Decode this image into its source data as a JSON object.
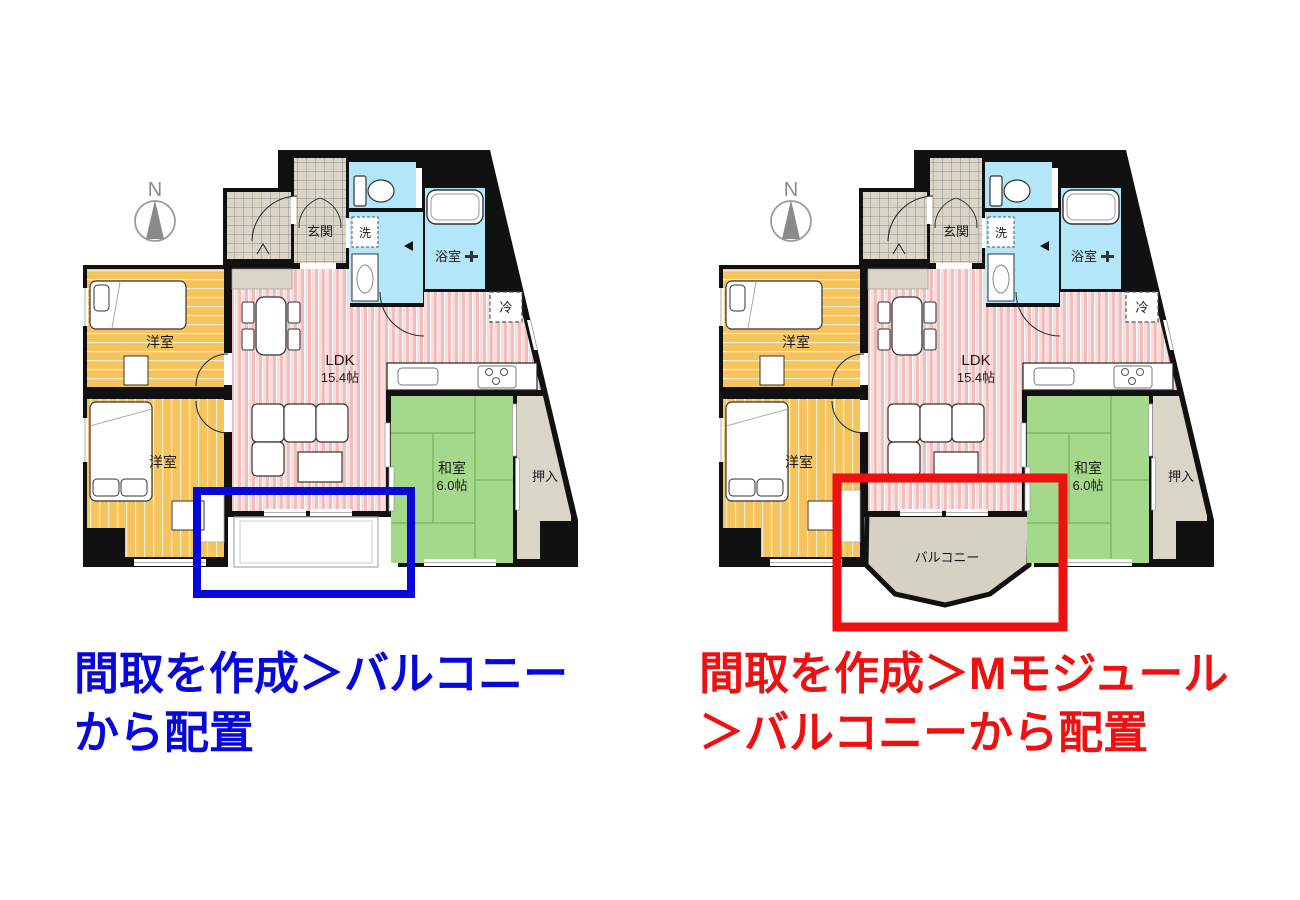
{
  "captions": {
    "left": {
      "line1": "間取を作成＞バルコニー",
      "line2": "から配置",
      "color": "#0808dd"
    },
    "right": {
      "line1": "間取を作成＞Mモジュール",
      "line2": "＞バルコニーから配置",
      "color": "#ee1111"
    }
  },
  "annotations": {
    "left_highlight_color": "#0808dd",
    "right_highlight_color": "#ee1111"
  },
  "floorplan": {
    "compass": "N",
    "rooms": {
      "entrance": "玄関",
      "laundry": "洗",
      "bathroom": "浴室",
      "fridge": "冷",
      "ldk_name": "LDK",
      "ldk_size": "15.4帖",
      "western_room_upper": "洋室",
      "western_room_lower": "洋室",
      "japanese_room_name": "和室",
      "japanese_room_size": "6.0帖",
      "closet": "押入",
      "balcony": "バルコニー"
    },
    "colors": {
      "wall": "#111111",
      "ldk_pink": "#f0bcbc",
      "western_orange": "#f5c45c",
      "tatami_green": "#a4d88a",
      "wet_area_blue": "#b3e6f8",
      "tile_beige": "#dad5c6",
      "balcony_beige": "#d6d2c3",
      "compass_gray": "#8a8a8a"
    }
  }
}
